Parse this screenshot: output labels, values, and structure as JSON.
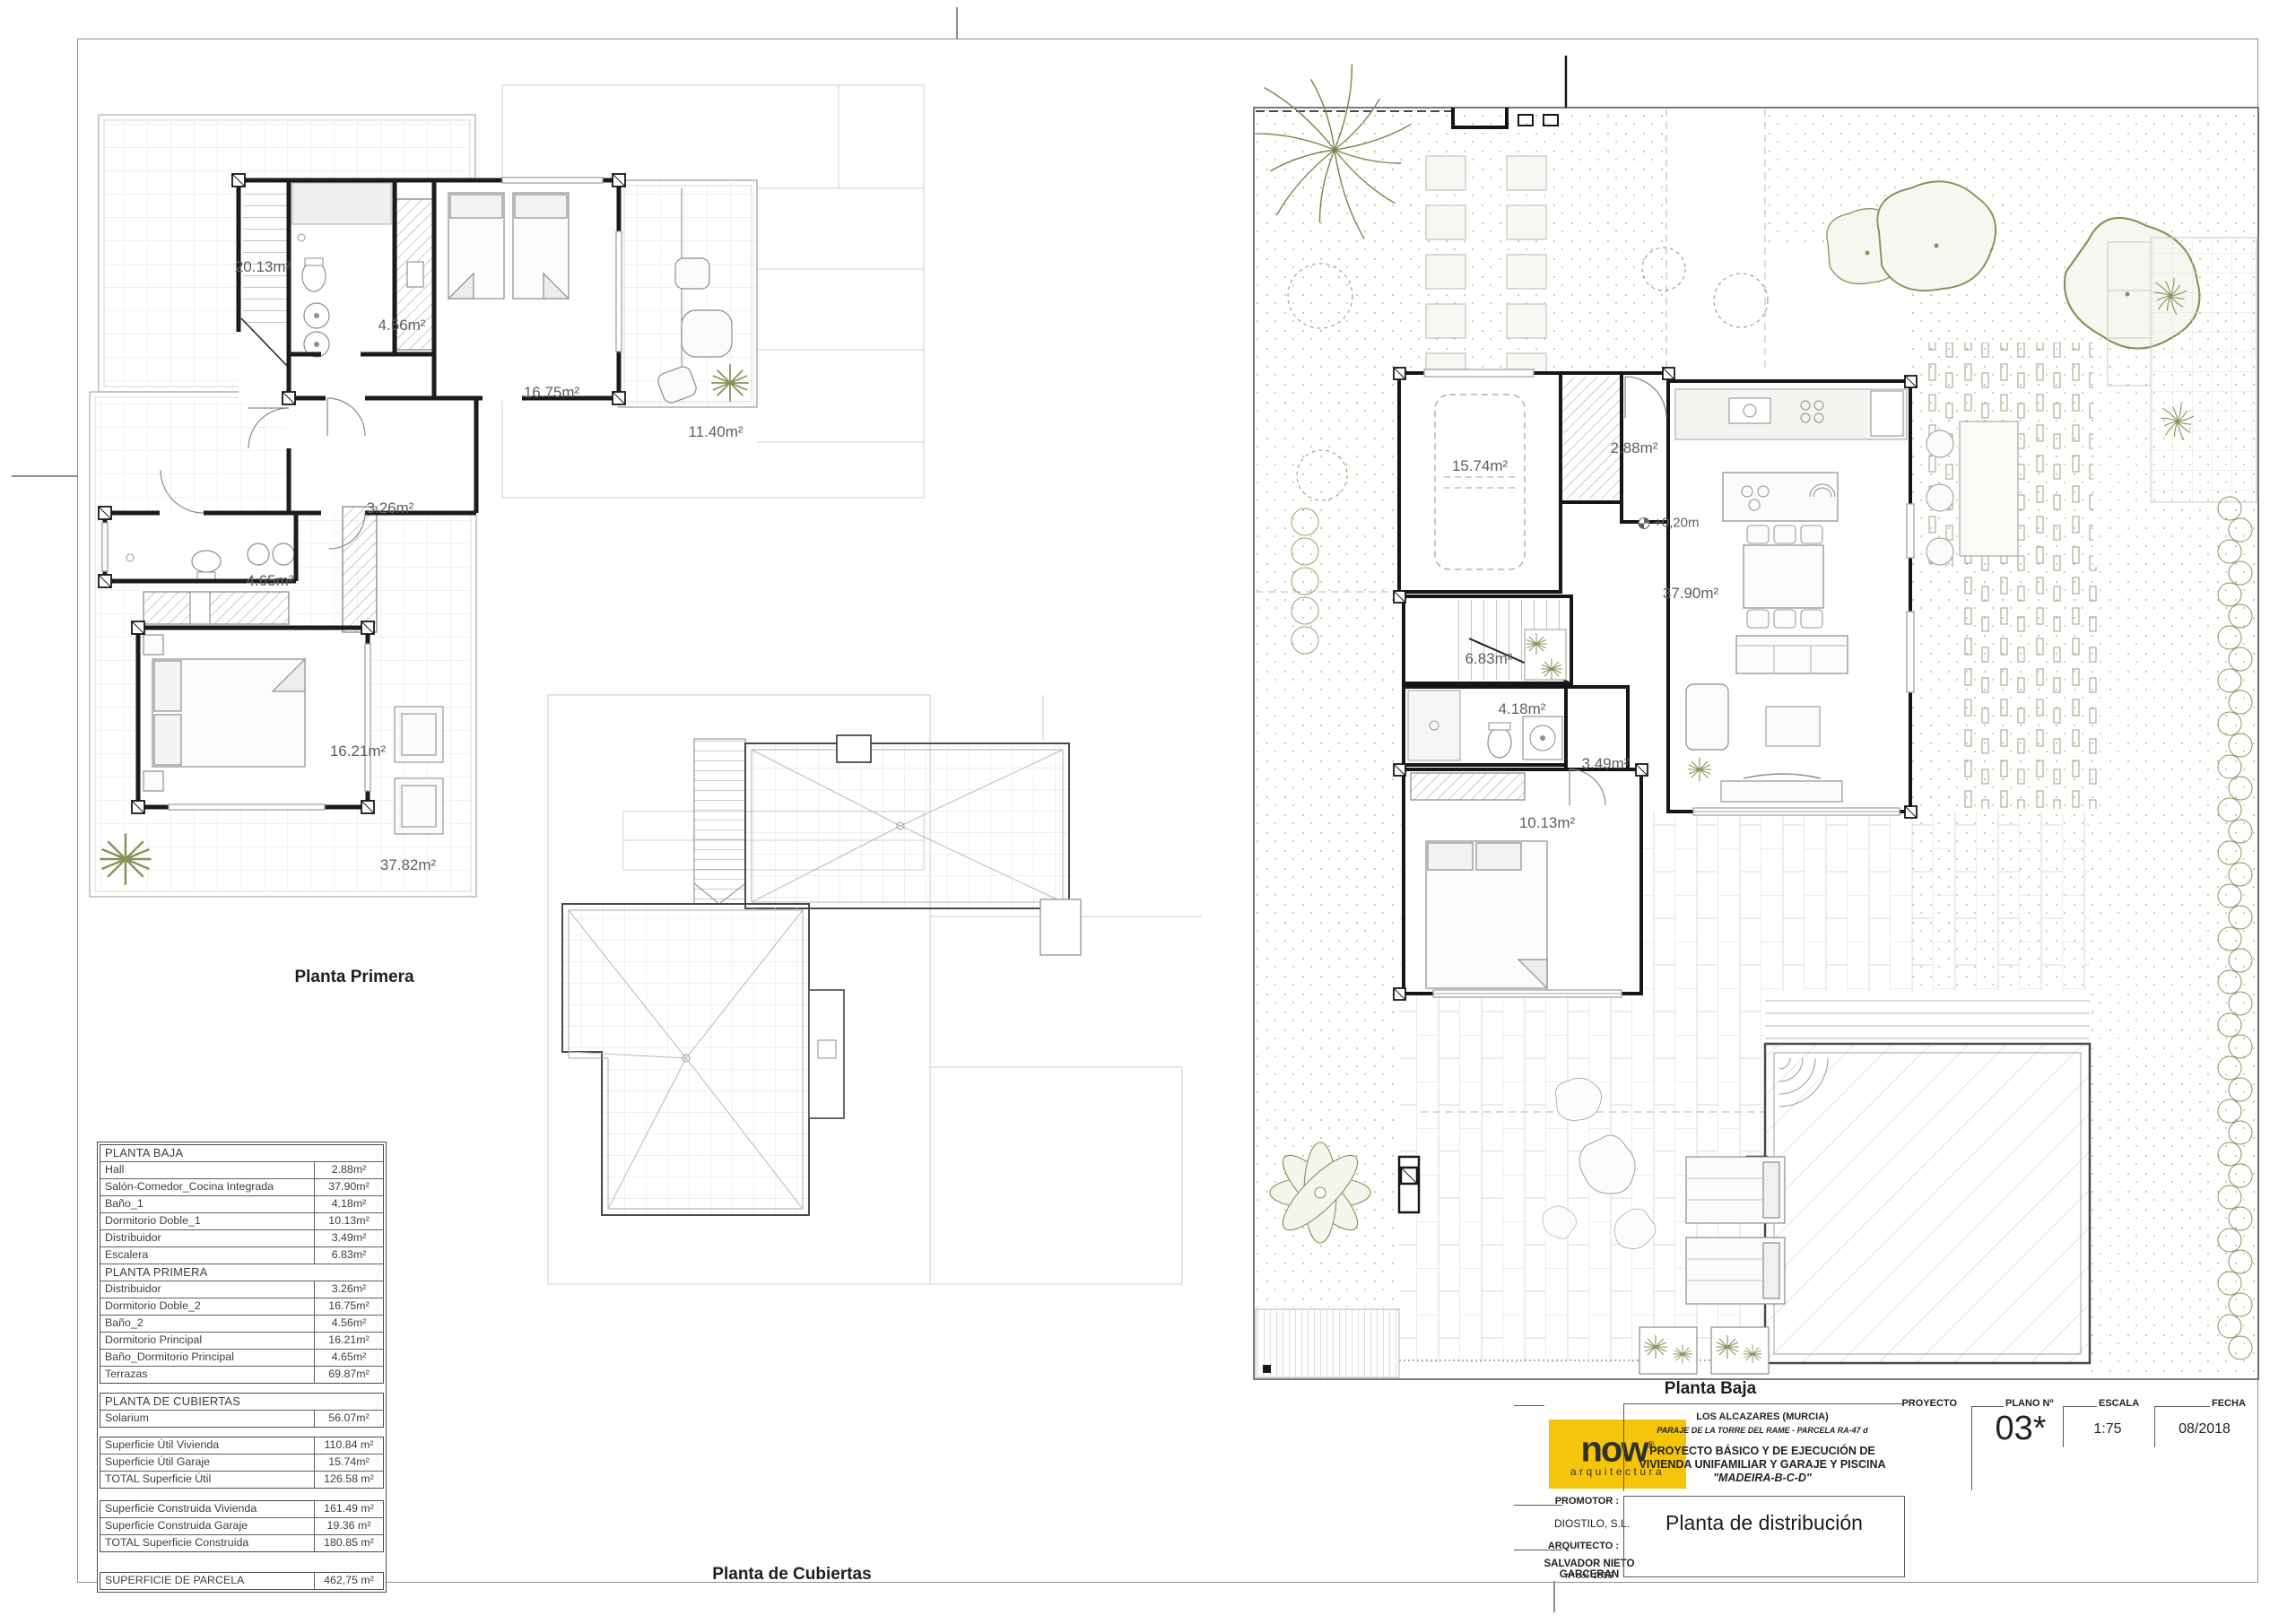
{
  "sheet": {
    "background": "#ffffff",
    "frame_color": "#8e8e8e"
  },
  "captions": {
    "planta_primera": "Planta Primera",
    "planta_cubiertas": "Planta de Cubiertas",
    "planta_baja": "Planta Baja"
  },
  "plan_labels": {
    "planta_primera": [
      "20.13m²",
      "4.56m²",
      "16.75m²",
      "11.40m²",
      "3.26m²",
      "4.65m²",
      "16.21m²",
      "37.82m²"
    ],
    "planta_baja": [
      "15.74m²",
      "2.88m²",
      "+0,20m",
      "37.90m²",
      "6.83m²",
      "4.18m²",
      "3.49m²",
      "10.13m²"
    ]
  },
  "areas_table": {
    "boxes": [
      {
        "groups": [
          {
            "header": "PLANTA BAJA",
            "rows": [
              [
                "Hall",
                "2.88m²"
              ],
              [
                "Salón-Comedor_Cocina Integrada",
                "37.90m²"
              ],
              [
                "Baño_1",
                "4.18m²"
              ],
              [
                "Dormitorio Doble_1",
                "10.13m²"
              ],
              [
                "Distribuidor",
                "3.49m²"
              ],
              [
                "Escalera",
                "6.83m²"
              ]
            ]
          },
          {
            "header": "PLANTA PRIMERA",
            "rows": [
              [
                "Distribuidor",
                "3.26m²"
              ],
              [
                "Dormitorio Doble_2",
                "16.75m²"
              ],
              [
                "Baño_2",
                "4.56m²"
              ],
              [
                "Dormitorio Principal",
                "16.21m²"
              ],
              [
                "Baño_Dormitorio Principal",
                "4.65m²"
              ],
              [
                "Terrazas",
                "69.87m²"
              ]
            ]
          }
        ]
      },
      {
        "groups": [
          {
            "header": "PLANTA DE CUBIERTAS",
            "rows": [
              [
                "Solarium",
                "56.07m²"
              ]
            ]
          }
        ]
      },
      {
        "groups": [
          {
            "header": null,
            "rows": [
              [
                "Superficie Útil Vivienda",
                "110.84 m²"
              ],
              [
                "Superficie Útil Garaje",
                "15.74m²"
              ],
              [
                "TOTAL Superficie Útil",
                "126.58 m²"
              ]
            ]
          }
        ]
      },
      {
        "groups": [
          {
            "header": null,
            "rows": [
              [
                "Superficie Construida Vivienda",
                "161.49 m²"
              ],
              [
                "Superficie Construida Garaje",
                "19.36 m²"
              ],
              [
                "TOTAL Superficie Construida",
                "180.85 m²"
              ]
            ]
          }
        ]
      },
      {
        "groups": [
          {
            "header": null,
            "rows": [
              [
                "SUPERFICIE DE PARCELA",
                "462,75 m²"
              ]
            ]
          }
        ]
      }
    ]
  },
  "title_block": {
    "logo": {
      "brand": "now",
      "registered": "®",
      "sub": "arquitectura",
      "bg": "#F5C50B",
      "fg": "#32302B"
    },
    "proyecto_label": "PROYECTO",
    "location_line1": "LOS ALCAZARES (MURCIA)",
    "location_line2": "PARAJE DE LA TORRE DEL RAME - PARCELA RA-47 d",
    "project_line1": "PROYECTO BÁSICO Y DE EJECUCIÓN DE",
    "project_line2": "VIVIENDA UNIFAMILIAR Y GARAJE Y PISCINA",
    "project_line3": "\"MADEIRA-B-C-D\"",
    "plano_label": "PLANO Nº",
    "plano_value": "03*",
    "escala_label": "ESCALA",
    "escala_value": "1:75",
    "fecha_label": "FECHA",
    "fecha_value": "08/2018",
    "promotor_label": "PROMOTOR :",
    "promotor_value": "DIOSTILO, S.L.",
    "arquitecto_label": "ARQUITECTO :",
    "arquitecto_value": "SALVADOR NIETO GARCERAN",
    "arquitecto_col": "nº col. 1858",
    "drawing_title": "Planta de distribución"
  }
}
